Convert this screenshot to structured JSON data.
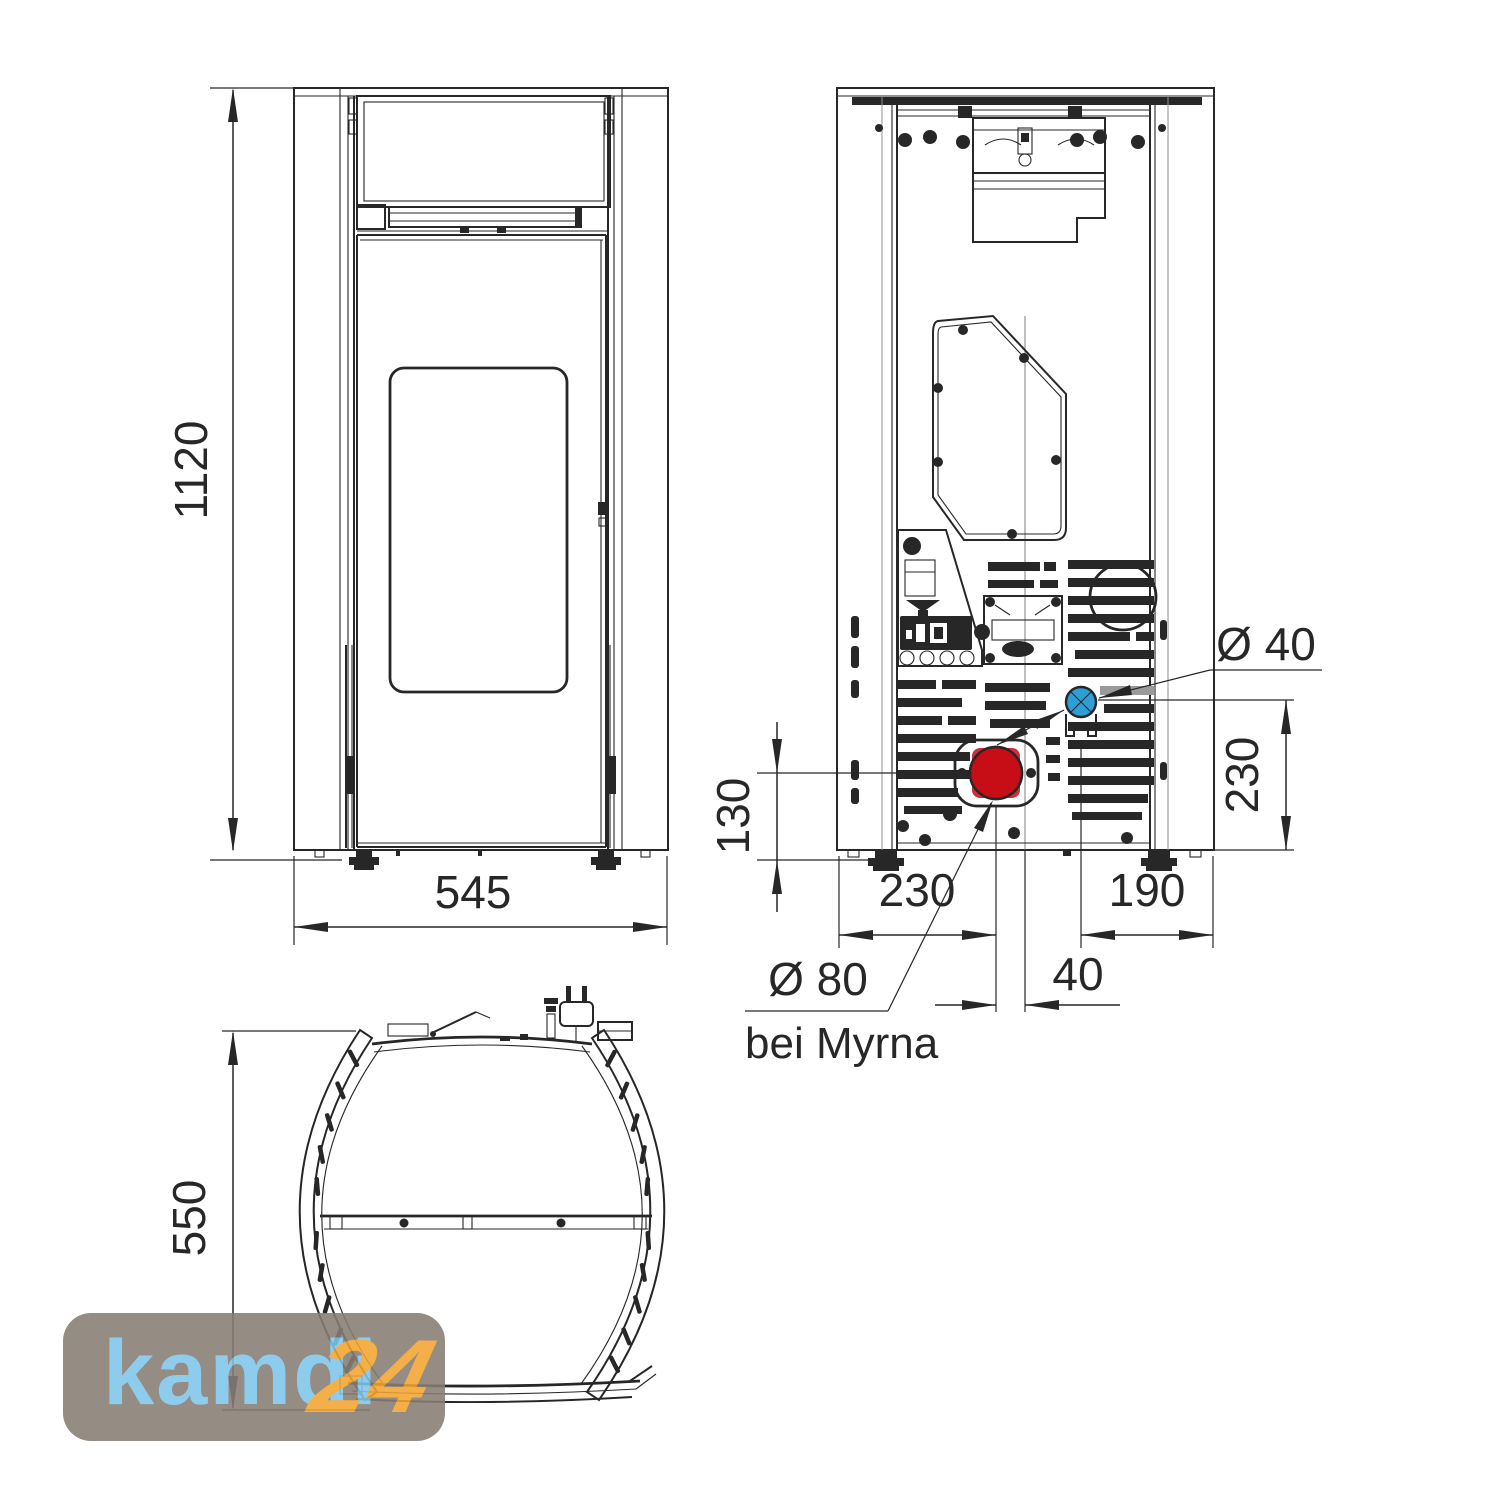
{
  "title": "Pellet stove dimensional drawing",
  "colors": {
    "line": "#272727",
    "soft_line": "#909090",
    "red": "#e0111b",
    "red_dark": "#c20d15",
    "blue": "#2e9fd6",
    "logo_bg": "#877d73",
    "logo_blue": "#7fc6eb",
    "logo_orange": "#f3a52f"
  },
  "views": {
    "front": {
      "height_mm": "1120",
      "width_mm": "545"
    },
    "rear": {
      "flue_height_mm": "130",
      "flue_from_left_mm": "230",
      "intake_from_right_mm": "190",
      "intake_height_mm": "230",
      "flue_from_center_mm": "40",
      "intake_diameter": "Ø 40",
      "flue_diameter": "Ø 80",
      "flue_note": "bei Myrna"
    },
    "top": {
      "depth_mm": "550"
    }
  },
  "watermark": {
    "brand": "kamdi",
    "suffix": "24"
  }
}
